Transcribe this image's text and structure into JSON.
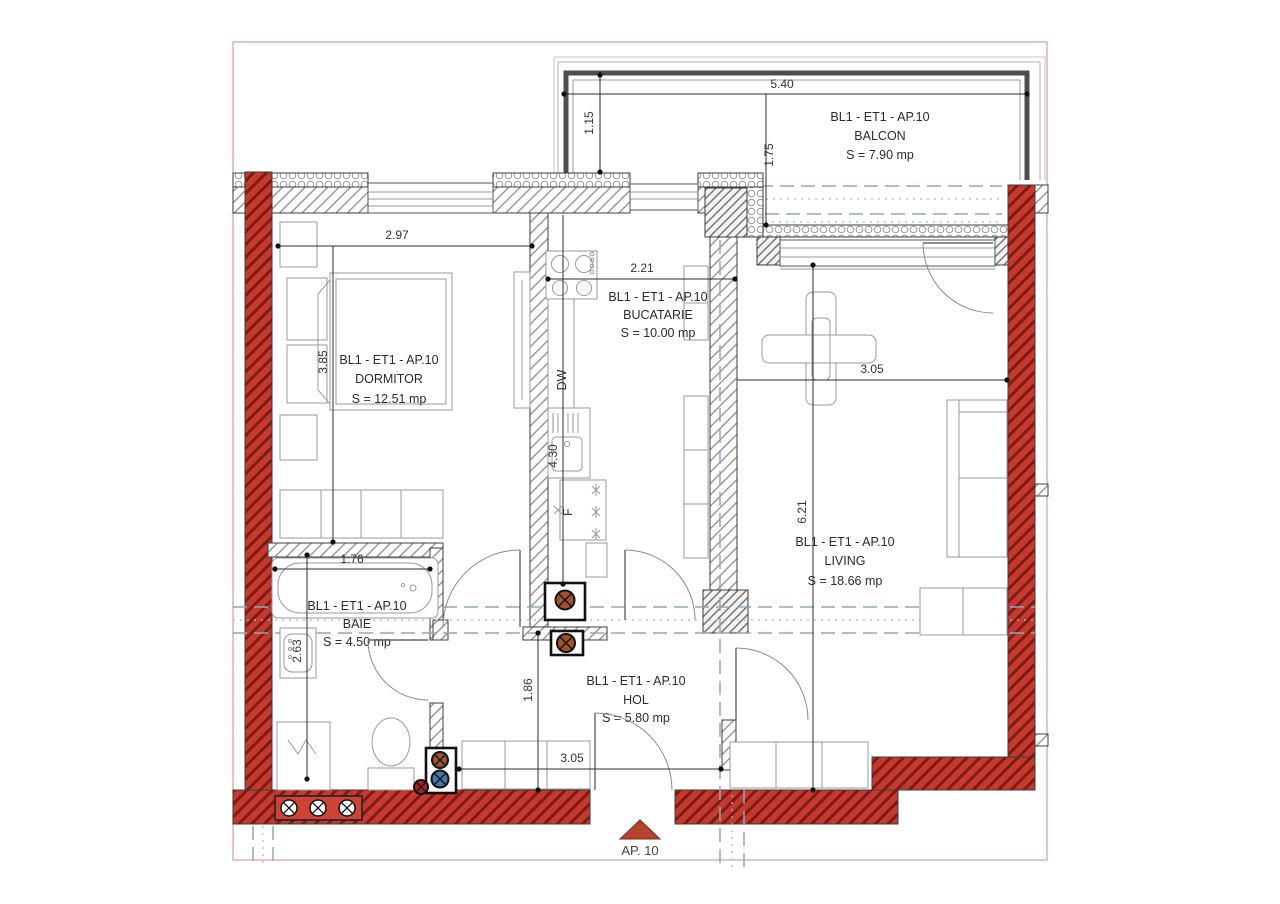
{
  "plan": {
    "title": "Apartment floor plan AP.10 — BL1 ET1",
    "rooms": {
      "balcon": {
        "code": "BL1 - ET1 - AP.10",
        "name": "BALCON",
        "area": "S = 7.90 mp"
      },
      "dormitor": {
        "code": "BL1 - ET1 - AP.10",
        "name": "DORMITOR",
        "area": "S = 12.51 mp"
      },
      "bucatarie": {
        "code": "BL1 - ET1 - AP.10",
        "name": "BUCATARIE",
        "area": "S = 10.00 mp"
      },
      "living": {
        "code": "BL1 - ET1 - AP.10",
        "name": "LIVING",
        "area": "S = 18.66 mp"
      },
      "baie": {
        "code": "BL1 - ET1 - AP.10",
        "name": "BAIE",
        "area": "S = 4.50 mp"
      },
      "hol": {
        "code": "BL1 - ET1 - AP.10",
        "name": "HOL",
        "area": "S = 5.80 mp"
      }
    },
    "dims": {
      "balcony_width": "5.40",
      "balcony_depth_left": "1.15",
      "balcony_depth_right": "1.75",
      "dormitor_width": "2.97",
      "dormitor_length": "3.85",
      "bucatarie_width": "2.21",
      "bucatarie_length": "4.30",
      "living_width": "3.05",
      "living_length": "6.21",
      "baie_width": "1.76",
      "baie_length": "2.63",
      "hol_length": "1.86",
      "hol_width": "3.05"
    },
    "labels": {
      "dishwasher": "DW",
      "fridge": "F",
      "entrance": "AP. 10"
    },
    "colors": {
      "structural_wall_red": "#c6392f",
      "structural_wall_hatch": "#7e1c14",
      "frame_pink": "#dd9e96",
      "section_line_blue": "#8fa8bc",
      "balcony_border_gray": "#4d4d4d",
      "entrance_arrow": "#b5432e",
      "pipe_brown": "#a0522d",
      "pipe_blue": "#4477aa",
      "pipe_red": "#aa2222"
    }
  }
}
